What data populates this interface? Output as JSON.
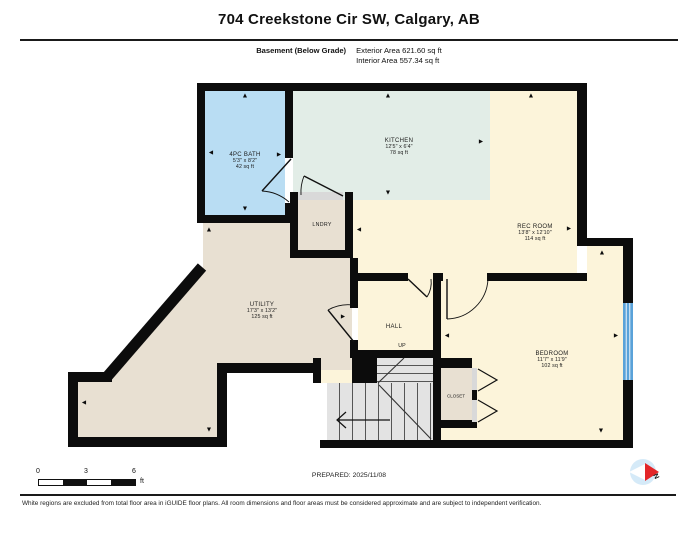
{
  "header": {
    "title": "704 Creekstone Cir SW, Calgary, AB",
    "floor_label": "Basement (Below Grade)",
    "exterior_area": "Exterior Area 621.60 sq ft",
    "interior_area": "Interior Area 557.34 sq ft"
  },
  "rooms": [
    {
      "name": "4PC BATH",
      "dims": "5'3\" x 8'2\"",
      "area": "42 sq ft"
    },
    {
      "name": "KITCHEN",
      "dims": "12'5\" x 6'4\"",
      "area": "78 sq ft"
    },
    {
      "name": "REC ROOM",
      "dims": "13'8\" x 12'10\"",
      "area": "114 sq ft"
    },
    {
      "name": "UTILITY",
      "dims": "17'3\" x 13'2\"",
      "area": "125 sq ft"
    },
    {
      "name": "BEDROOM",
      "dims": "11'7\" x 11'9\"",
      "area": "102 sq ft"
    },
    {
      "name": "LNDRY"
    },
    {
      "name": "HALL",
      "up_label": "UP"
    },
    {
      "name": "CLOSET"
    }
  ],
  "scale_bar": {
    "labels": [
      "0",
      "3",
      "6"
    ],
    "unit": "ft"
  },
  "footer": {
    "prepared": "PREPARED: 2025/11/08",
    "north_label": "N",
    "disclaimer": "White regions are excluded from total floor area in iGUIDE floor plans. All room dimensions and floor areas must be considered approximate and are subject to independent verification."
  },
  "colors": {
    "wall": "#0c0c0c",
    "bath": "#b9ddf3",
    "kitchen": "#e2ede7",
    "living_cream": "#fcf4da",
    "utility_beige": "#e8e0d2",
    "stairs_gray": "#e3e3e3",
    "window_blue": "#5aa2d9",
    "compass_red": "#e32629"
  }
}
